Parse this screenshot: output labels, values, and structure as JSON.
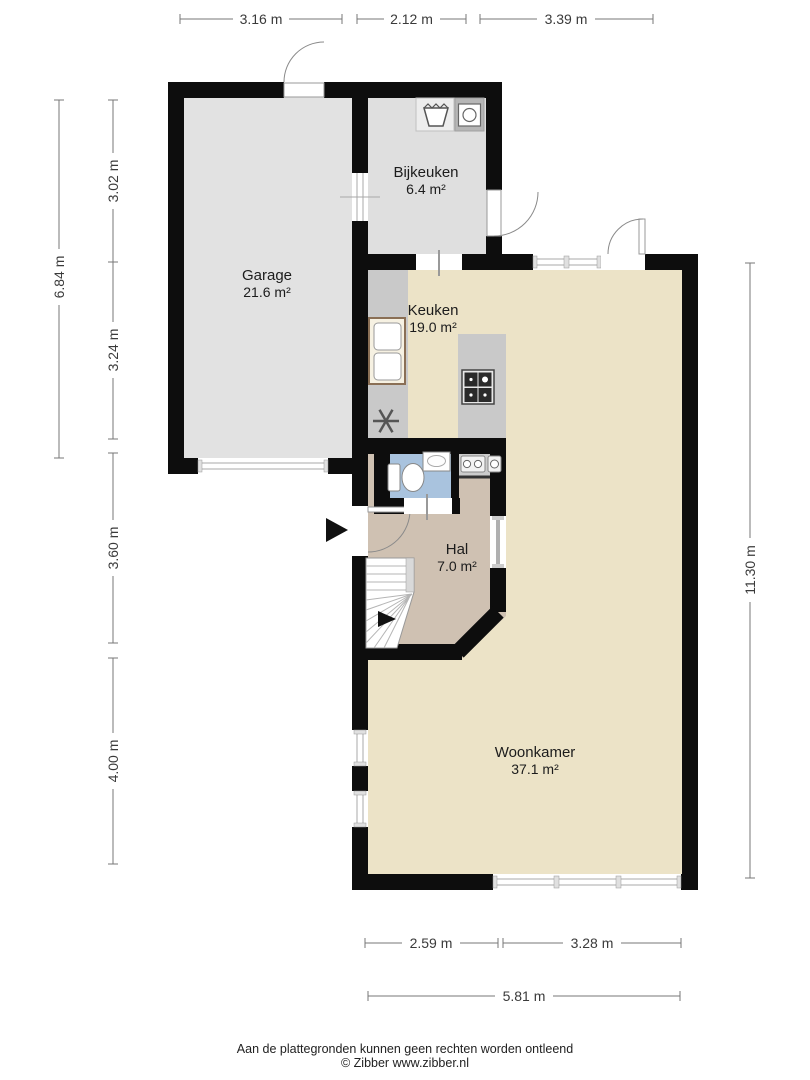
{
  "plan_title": "Begane grond plattegrond",
  "rooms": {
    "garage": {
      "name": "Garage",
      "area": "21.6 m²"
    },
    "bijkeuken": {
      "name": "Bijkeuken",
      "area": "6.4 m²"
    },
    "keuken": {
      "name": "Keuken",
      "area": "19.0 m²"
    },
    "hal": {
      "name": "Hal",
      "area": "7.0 m²"
    },
    "woonkamer": {
      "name": "Woonkamer",
      "area": "37.1 m²"
    }
  },
  "dimensions": {
    "top": [
      "3.16 m",
      "2.12 m",
      "3.39 m"
    ],
    "left_outer": "6.84 m",
    "left_inner": [
      "3.02 m",
      "3.24 m",
      "3.60 m",
      "4.00 m"
    ],
    "right": "11.30 m",
    "bottom_inner": [
      "2.59 m",
      "3.28 m"
    ],
    "bottom_total": "5.81 m"
  },
  "footer": {
    "disclaimer": "Aan de plattegronden kunnen geen rechten worden ontleend",
    "credit": "© Zibber www.zibber.nl"
  },
  "colors": {
    "wall": "#0d0d0d",
    "garage_floor": "#e2e2e2",
    "bijkeuken_floor": "#dfdfdf",
    "living_floor": "#ece3c7",
    "hal_floor": "#cfc1b2",
    "toilet_floor": "#a9c3de",
    "counter": "#c9c9c9",
    "window_line": "#a8a8a8",
    "door_line": "#8a8a8a",
    "fixture_line": "#888888",
    "sink_border": "#8a6f55"
  }
}
